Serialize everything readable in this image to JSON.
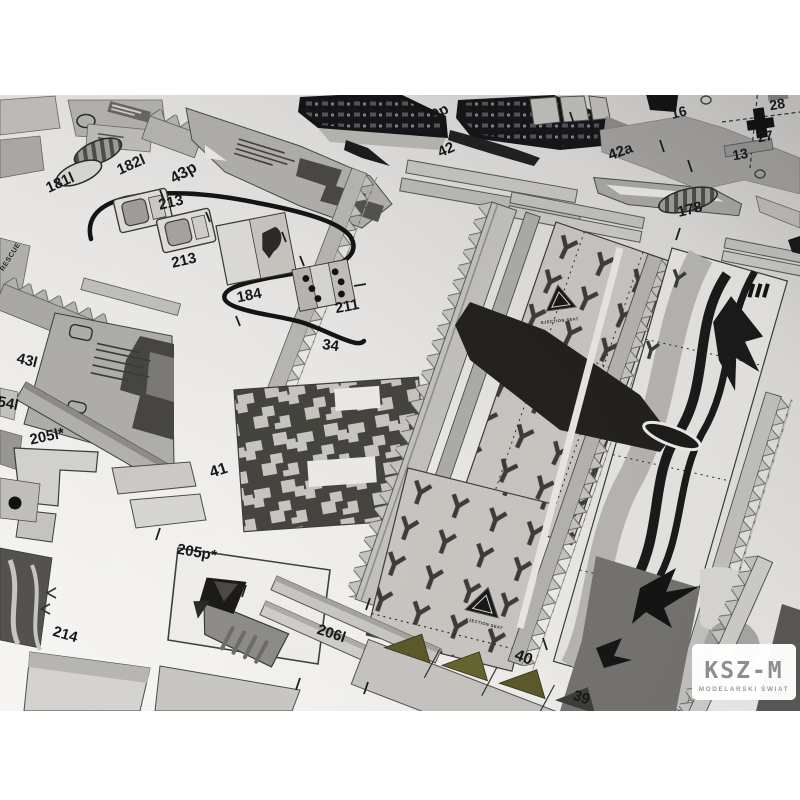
{
  "image_kind": "photograph of a paper card-model kit parts sheet (aircraft model), letterboxed on white",
  "logo": {
    "title": "KSZ-M",
    "subtitle": "MODELARSKI ŚWIAT"
  },
  "part_labels": [
    {
      "text": "181l",
      "x": 62,
      "y": 187,
      "rot": -24,
      "size": 15
    },
    {
      "text": "182l",
      "x": 133,
      "y": 169,
      "rot": -24,
      "size": 15
    },
    {
      "text": "43p",
      "x": 186,
      "y": 177,
      "rot": -30,
      "size": 16
    },
    {
      "text": "213",
      "x": 172,
      "y": 207,
      "rot": -13,
      "size": 15
    },
    {
      "text": "213",
      "x": 185,
      "y": 265,
      "rot": -13,
      "size": 15
    },
    {
      "text": "184",
      "x": 250,
      "y": 300,
      "rot": -11,
      "size": 15
    },
    {
      "text": "211",
      "x": 348,
      "y": 311,
      "rot": -11,
      "size": 15
    },
    {
      "text": "34",
      "x": 330,
      "y": 350,
      "rot": 8,
      "size": 15
    },
    {
      "text": "9p",
      "x": 442,
      "y": 116,
      "rot": -28,
      "size": 15
    },
    {
      "text": "42",
      "x": 448,
      "y": 154,
      "rot": -24,
      "size": 15
    },
    {
      "text": "42a",
      "x": 622,
      "y": 156,
      "rot": -20,
      "size": 15
    },
    {
      "text": "16",
      "x": 680,
      "y": 117,
      "rot": -14,
      "size": 14
    },
    {
      "text": "28",
      "x": 778,
      "y": 109,
      "rot": -10,
      "size": 14
    },
    {
      "text": "27",
      "x": 766,
      "y": 141,
      "rot": -10,
      "size": 14
    },
    {
      "text": "13",
      "x": 741,
      "y": 159,
      "rot": -10,
      "size": 14
    },
    {
      "text": "178",
      "x": 691,
      "y": 214,
      "rot": -14,
      "size": 15
    },
    {
      "text": "43l",
      "x": 26,
      "y": 365,
      "rot": 14,
      "size": 15
    },
    {
      "text": "54l",
      "x": 7,
      "y": 408,
      "rot": 12,
      "size": 15
    },
    {
      "text": "205l*",
      "x": 48,
      "y": 441,
      "rot": -12,
      "size": 15
    },
    {
      "text": "41",
      "x": 220,
      "y": 475,
      "rot": -18,
      "size": 16
    },
    {
      "text": "205p*",
      "x": 196,
      "y": 557,
      "rot": 10,
      "size": 15
    },
    {
      "text": "214",
      "x": 64,
      "y": 639,
      "rot": 16,
      "size": 15
    },
    {
      "text": "206l",
      "x": 330,
      "y": 638,
      "rot": 18,
      "size": 15
    },
    {
      "text": "40",
      "x": 522,
      "y": 662,
      "rot": 20,
      "size": 16
    },
    {
      "text": "39",
      "x": 580,
      "y": 702,
      "rot": 18,
      "size": 15
    }
  ],
  "micro_labels": [
    {
      "text": "RESCUE",
      "x": 12,
      "y": 258,
      "rot": -58,
      "size": 7
    },
    {
      "text": "EJECTION SEAT",
      "x": 560,
      "y": 322,
      "rot": -6,
      "size": 4
    },
    {
      "text": "EJECTION SEAT",
      "x": 484,
      "y": 625,
      "rot": 14,
      "size": 4
    }
  ],
  "colors": {
    "paper_light": "#f7f6f4",
    "paper_dark": "#d2d0ce",
    "part_light": "#c6c4c1",
    "part_mid": "#a5a3a1",
    "part_dark": "#474643",
    "ink": "#1a1a1a",
    "olive": "#5c5a2b",
    "logo_gray": "#8e8e8e",
    "letterbox": "#ffffff"
  }
}
